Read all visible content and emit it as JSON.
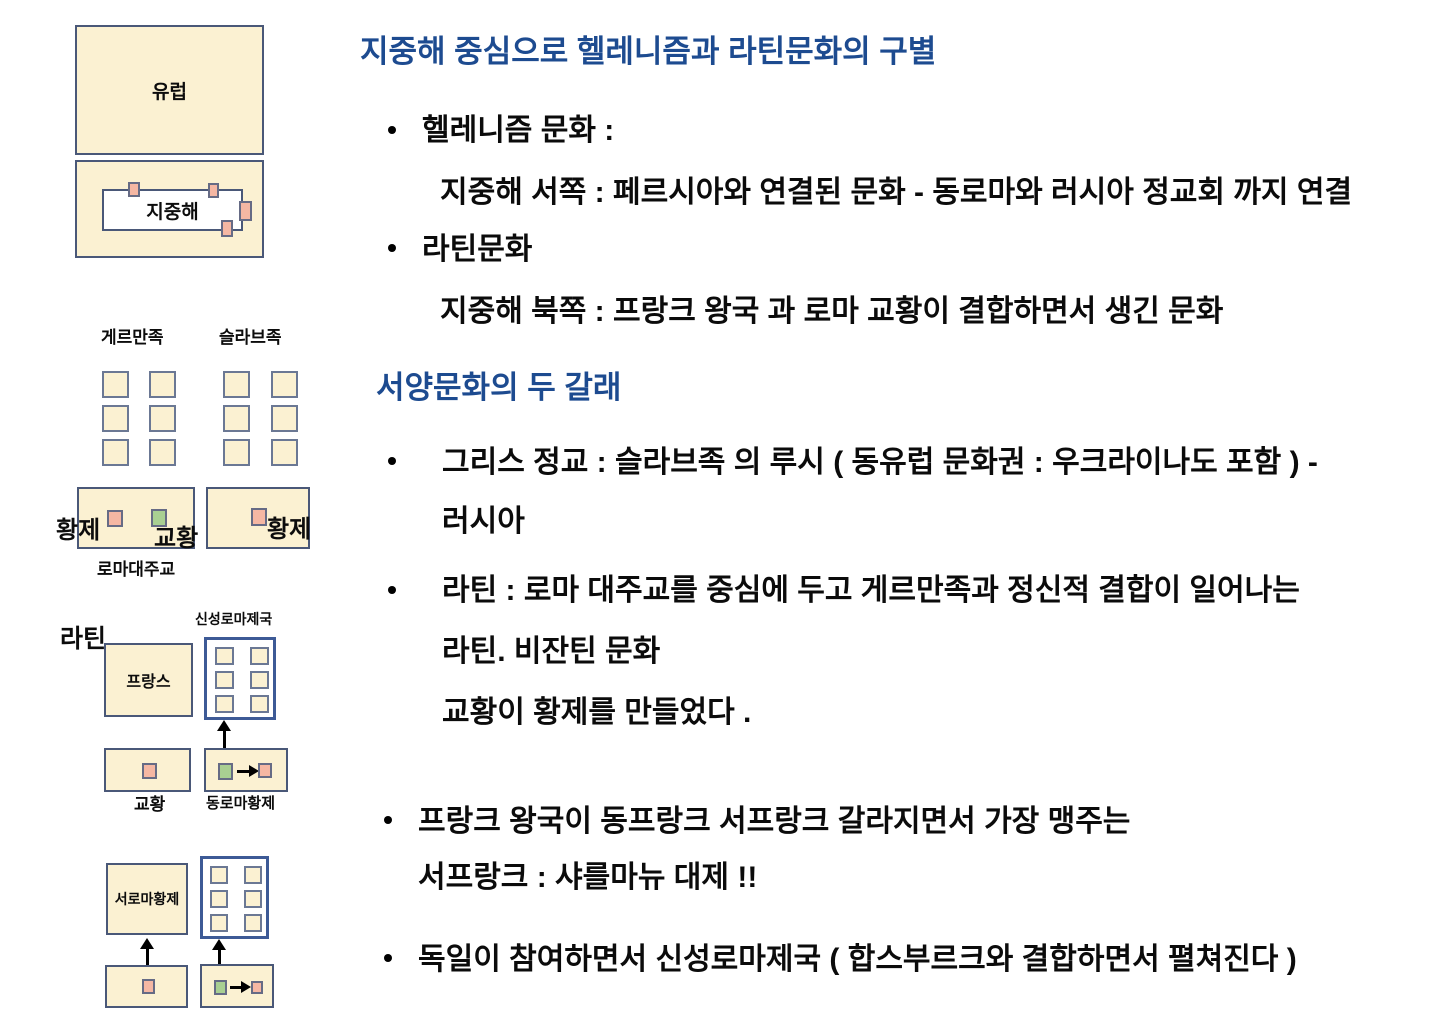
{
  "colors": {
    "box_fill": "#fbf1d2",
    "box_border": "#4a5878",
    "grid_border": "#6b7894",
    "sq_border": "#666b85",
    "pink_fill": "#f5b7a3",
    "green_fill": "#a9cf92",
    "hre_border": "#3d5a96",
    "heading_blue": "#1d4b90",
    "text_black": "#0b0b0b"
  },
  "bullet_char": "•",
  "diagram_europe": {
    "europe_label": "유럽",
    "mediterranean_label": "지중해"
  },
  "diagram_peoples": {
    "germanic_label": "게르만족",
    "slavic_label": "슬라브족",
    "emperor_left_label": "황제",
    "pope_label": "교황",
    "emperor_right_label": "황제",
    "archbishop_label": "로마대주교"
  },
  "diagram_latin": {
    "latin_label": "라틴",
    "hre_label": "신성로마제국",
    "france_label": "프랑스",
    "pope_label": "교황",
    "east_emperor_label": "동로마황제"
  },
  "diagram_west": {
    "west_emperor_label": "서로마황제"
  },
  "notes": {
    "section1": {
      "title": "지중해 중심으로 헬레니즘과 라틴문화의 구별",
      "bullet1": "헬레니즘 문화 :",
      "bullet1_sub": "지중해 서쪽 : 페르시아와 연결된 문화 - 동로마와 러시아 정교회 까지 연결",
      "bullet2": "라틴문화",
      "bullet2_sub": "지중해 북쪽 : 프랑크 왕국 과 로마 교황이 결합하면서 생긴 문화"
    },
    "section2": {
      "title": "서양문화의 두 갈래",
      "bullet1_line1": "그리스 정교 : 슬라브족 의 루시 ( 동유럽 문화권 : 우크라이나도 포함 ) -",
      "bullet1_line2": "러시아",
      "bullet2_line1": "라틴 :  로마 대주교를 중심에 두고 게르만족과 정신적 결합이 일어나는",
      "bullet2_line2": "라틴. 비잔틴 문화",
      "bullet2_line3": "교황이 황제를 만들었다 ."
    },
    "section3": {
      "bullet1_line1": "프랑크 왕국이 동프랑크 서프랑크 갈라지면서 가장 맹주는",
      "bullet1_line2": "서프랑크 : 샤를마뉴 대제  !!",
      "bullet2_line1": "독일이 참여하면서 신성로마제국 ( 합스부르크와 결합하면서 펼쳐진다 )"
    }
  }
}
